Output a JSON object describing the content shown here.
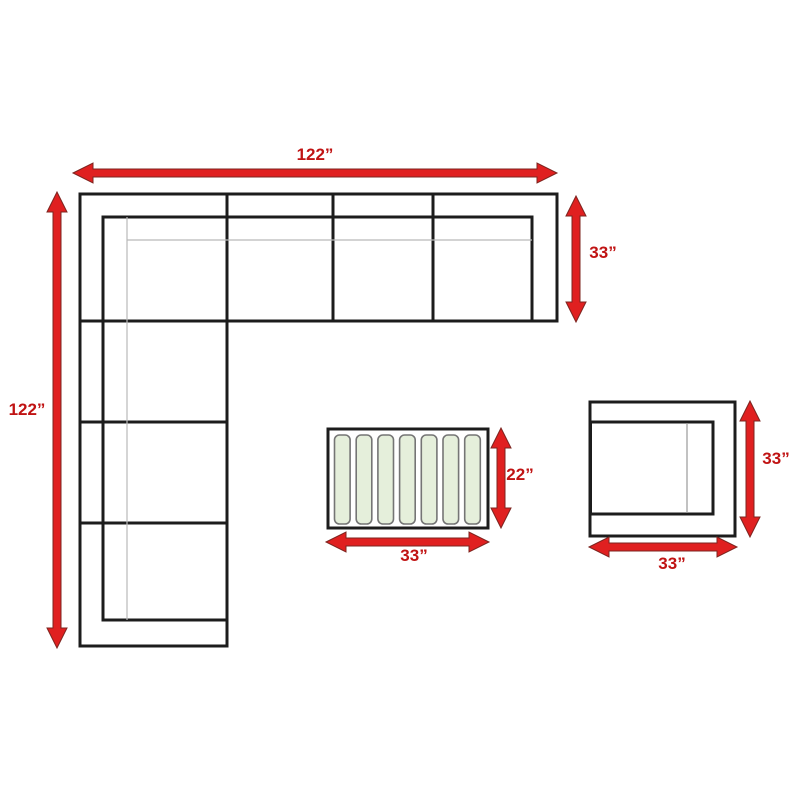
{
  "figure": {
    "background": "#ffffff",
    "line_color": "#1c1c1c",
    "thin_line_color": "#b9b9b9",
    "arrow_color": "#e02020",
    "label_color": "#c01313",
    "sectional_sofa": {
      "name": "L-shaped sectional sofa top view",
      "width_label": "122”",
      "height_label": "122”",
      "depth_label": "33”"
    },
    "coffee_table": {
      "name": "slatted coffee table top view",
      "width_label": "33”",
      "depth_label": "22”",
      "slat_count": 7,
      "slat_fill": "#e5efdb",
      "slat_border": "#757575"
    },
    "corner_chair": {
      "name": "corner chair top view",
      "width_label": "33”",
      "depth_label": "33”"
    }
  }
}
